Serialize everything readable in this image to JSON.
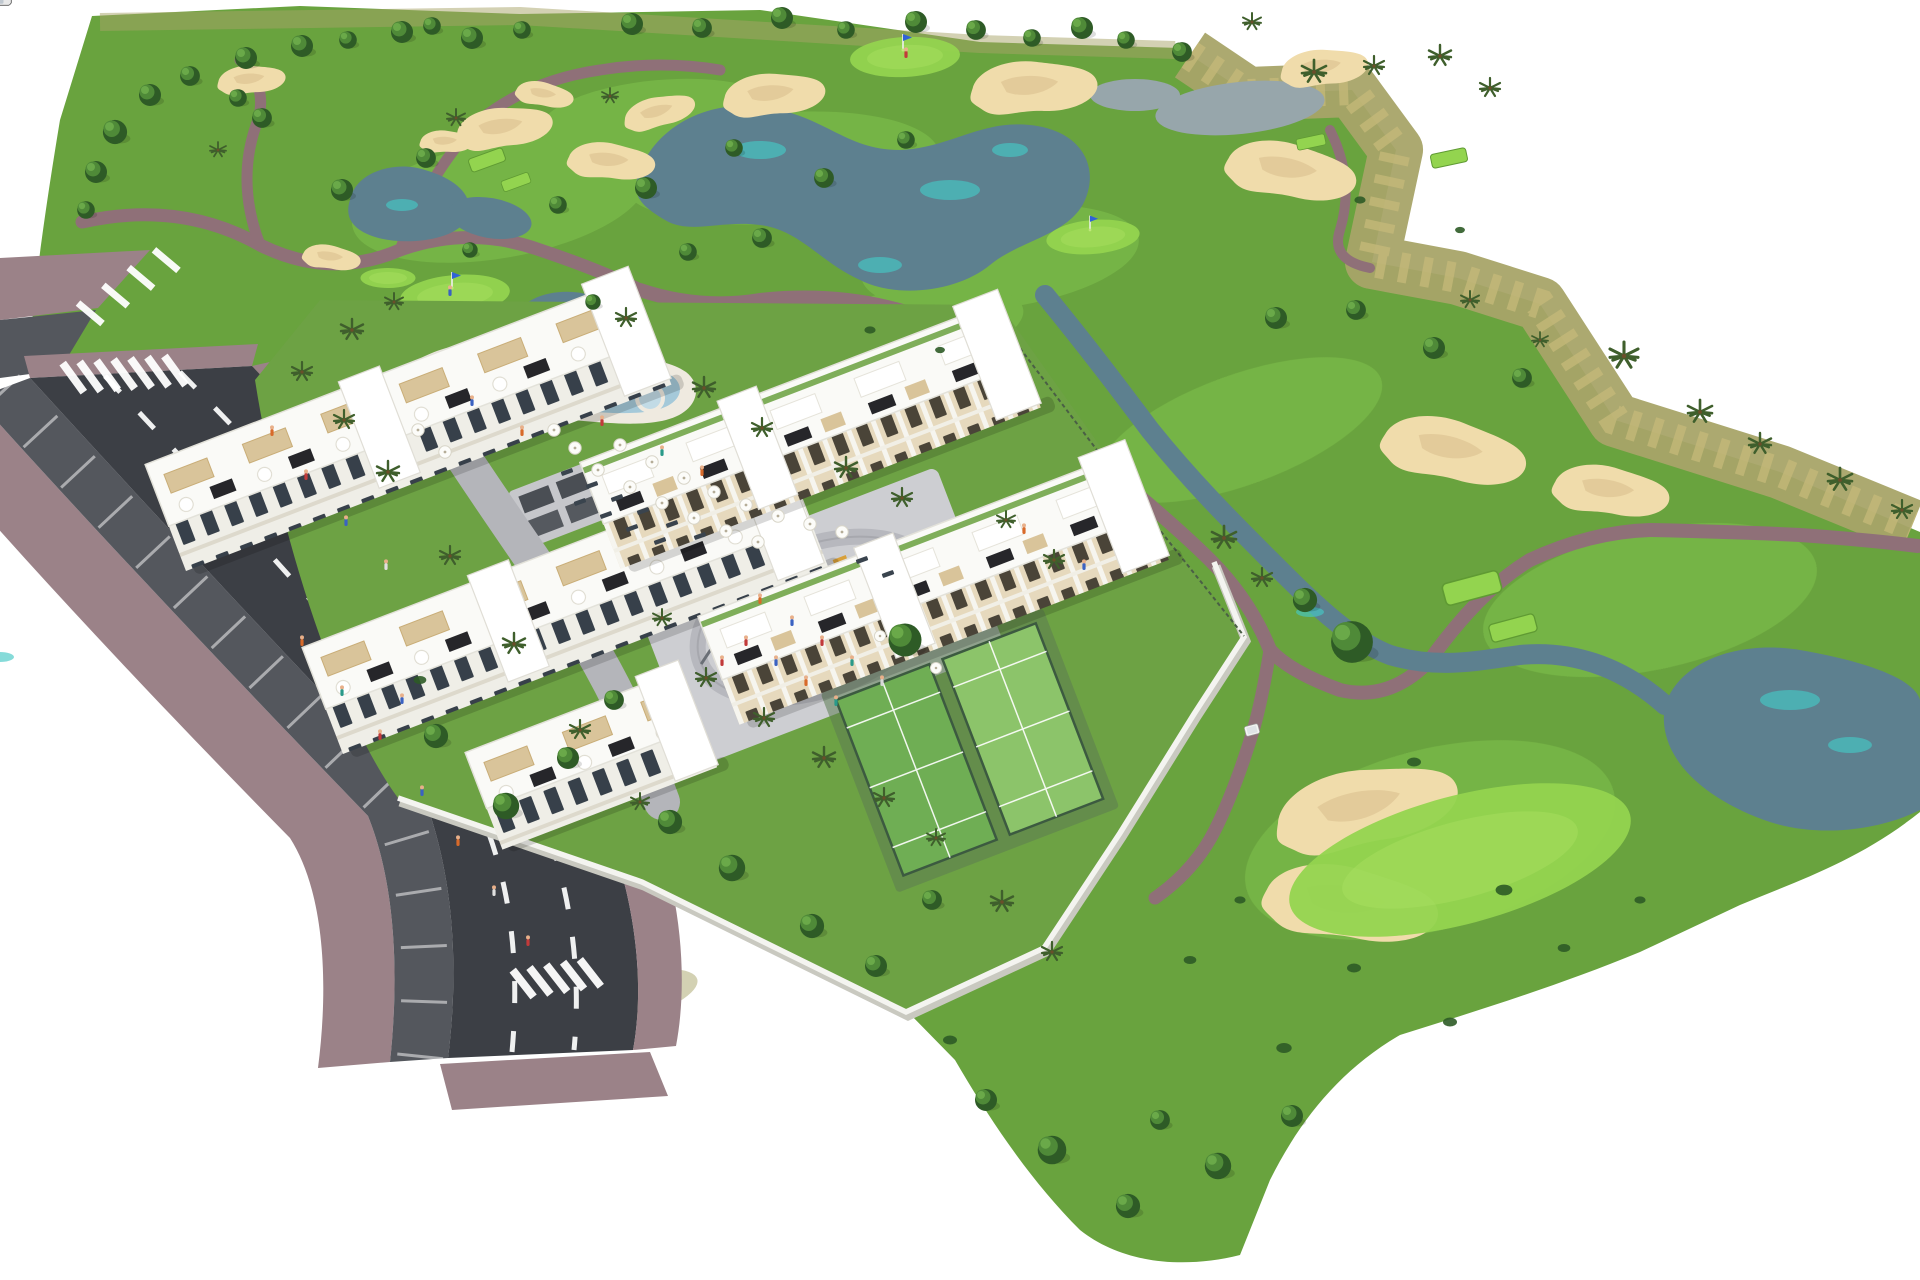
{
  "meta": {
    "title": "Aerial 3D masterplan render - golf resort apartments",
    "description": "Bird's-eye architectural rendering of white apartment blocks with roof terraces beside a golf course with lakes, sand bunkers, cart paths, a lagoon pool, playground plaza, padel courts and a tree-lined access road on white background.",
    "features": [
      "golf-course",
      "lakes",
      "streams",
      "sand-bunkers",
      "cart-paths",
      "apartment-blocks",
      "roof-terraces",
      "swimming-pool",
      "sun-umbrellas",
      "playground-plaza",
      "padel-courts",
      "access-road",
      "street-parking",
      "crosswalks",
      "perimeter-wall",
      "golf-greens-with-flags",
      "golf-cart",
      "palm-trees"
    ]
  },
  "palette": {
    "grass": "#69a33e",
    "fairway": "#82c44e",
    "teegreen": "#93d44f",
    "arid": "#a8a468",
    "aridlight": "#c8bb7a",
    "water": "#5d808f",
    "watercyan": "#45c8c4",
    "sand": "#f0dcab",
    "sandshade": "#d9bd8d",
    "path": "#8f7078",
    "road": "#3c3f45",
    "parking": "#54575d",
    "sidewalk": "#9b8288",
    "plaza": "#cdced2",
    "wall": "#f4f4f0",
    "building": "#fafaf7",
    "facade": "#efeee7",
    "window": "#37404a",
    "wood": "#c39a63",
    "woodlight": "#d9c49a",
    "panel": "#26262a",
    "poolwater": "#a5c9d9",
    "pooldeck": "#efeae0",
    "court": "#6fae54",
    "treedark": "#2e5b26",
    "tree": "#4f8a38",
    "treelight": "#6fae4c",
    "palm": "#3f5f2c",
    "shadow": "#00000026",
    "skin": "#e8b08a"
  },
  "scatter": {
    "trees": {
      "sym": "tree",
      "items": [
        [
          150,
          95,
          1
        ],
        [
          115,
          132,
          1.1
        ],
        [
          96,
          172,
          1
        ],
        [
          86,
          210,
          0.8
        ],
        [
          190,
          76,
          0.9
        ],
        [
          246,
          58,
          1
        ],
        [
          302,
          46,
          1
        ],
        [
          348,
          40,
          0.8
        ],
        [
          402,
          32,
          1
        ],
        [
          432,
          26,
          0.8
        ],
        [
          472,
          38,
          1
        ],
        [
          522,
          30,
          0.8
        ],
        [
          632,
          24,
          1
        ],
        [
          702,
          28,
          0.9
        ],
        [
          782,
          18,
          1
        ],
        [
          846,
          30,
          0.8
        ],
        [
          916,
          22,
          1
        ],
        [
          976,
          30,
          0.9
        ],
        [
          1032,
          38,
          0.8
        ],
        [
          1082,
          28,
          1
        ],
        [
          1126,
          40,
          0.8
        ],
        [
          1182,
          52,
          0.9
        ],
        [
          262,
          118,
          0.9
        ],
        [
          238,
          98,
          0.8
        ],
        [
          342,
          190,
          1
        ],
        [
          426,
          158,
          0.9
        ],
        [
          558,
          205,
          0.8
        ],
        [
          646,
          188,
          1
        ],
        [
          734,
          148,
          0.8
        ],
        [
          824,
          178,
          0.9
        ],
        [
          906,
          140,
          0.8
        ],
        [
          762,
          238,
          0.9
        ],
        [
          688,
          252,
          0.8
        ],
        [
          593,
          302,
          0.7
        ],
        [
          470,
          250,
          0.7
        ],
        [
          1276,
          318,
          1
        ],
        [
          1356,
          310,
          0.9
        ],
        [
          1434,
          348,
          1
        ],
        [
          1522,
          378,
          0.9
        ],
        [
          1352,
          642,
          1.9
        ],
        [
          1305,
          600,
          1.1
        ],
        [
          1052,
          1150,
          1.3
        ],
        [
          1128,
          1206,
          1.1
        ],
        [
          986,
          1100,
          1
        ],
        [
          1218,
          1166,
          1.2
        ],
        [
          1292,
          1116,
          1
        ],
        [
          1160,
          1120,
          0.9
        ],
        [
          436,
          736,
          1.1
        ],
        [
          506,
          806,
          1.2
        ],
        [
          568,
          758,
          1
        ],
        [
          614,
          700,
          0.9
        ],
        [
          670,
          822,
          1.1
        ],
        [
          732,
          868,
          1.2
        ],
        [
          812,
          926,
          1.1
        ],
        [
          876,
          966,
          1
        ],
        [
          932,
          900,
          0.9
        ],
        [
          905,
          640,
          1.5
        ]
      ]
    },
    "palms": {
      "sym": "palm",
      "items": [
        [
          302,
          372,
          1
        ],
        [
          344,
          420,
          1
        ],
        [
          388,
          472,
          1.1
        ],
        [
          450,
          556,
          1
        ],
        [
          514,
          644,
          1.1
        ],
        [
          580,
          730,
          1
        ],
        [
          640,
          802,
          0.9
        ],
        [
          352,
          330,
          1.1
        ],
        [
          394,
          302,
          0.9
        ],
        [
          626,
          318,
          1
        ],
        [
          704,
          388,
          1.1
        ],
        [
          762,
          428,
          1
        ],
        [
          846,
          468,
          1.1
        ],
        [
          902,
          498,
          1
        ],
        [
          662,
          618,
          0.9
        ],
        [
          706,
          678,
          1
        ],
        [
          764,
          718,
          1
        ],
        [
          824,
          758,
          1.1
        ],
        [
          884,
          798,
          1
        ],
        [
          936,
          838,
          0.9
        ],
        [
          1224,
          538,
          1.2
        ],
        [
          1262,
          578,
          1
        ],
        [
          1006,
          520,
          0.9
        ],
        [
          1054,
          560,
          1
        ],
        [
          1002,
          902,
          1.1
        ],
        [
          1052,
          952,
          1
        ],
        [
          456,
          118,
          0.9
        ],
        [
          610,
          96,
          0.8
        ],
        [
          218,
          150,
          0.8
        ],
        [
          1314,
          72,
          1.2
        ],
        [
          1374,
          66,
          1
        ],
        [
          1440,
          56,
          1.1
        ],
        [
          1490,
          88,
          1
        ],
        [
          1252,
          22,
          0.9
        ],
        [
          1624,
          356,
          1.4
        ],
        [
          1700,
          412,
          1.2
        ],
        [
          1760,
          444,
          1.1
        ],
        [
          1840,
          480,
          1.2
        ],
        [
          1902,
          510,
          1
        ],
        [
          1470,
          300,
          0.9
        ],
        [
          1540,
          340,
          0.8
        ]
      ]
    },
    "bushes": {
      "sym": "bush",
      "items": [
        [
          1414,
          762,
          1
        ],
        [
          1504,
          890,
          1.2
        ],
        [
          1354,
          968,
          1
        ],
        [
          1284,
          1048,
          1.1
        ],
        [
          1450,
          1022,
          1
        ],
        [
          1564,
          948,
          0.9
        ],
        [
          1640,
          900,
          0.8
        ],
        [
          420,
          680,
          0.9
        ],
        [
          950,
          1040,
          1
        ],
        [
          1240,
          900,
          0.8
        ],
        [
          1190,
          960,
          0.9
        ],
        [
          870,
          330,
          0.8
        ],
        [
          940,
          350,
          0.7
        ],
        [
          1360,
          200,
          0.8
        ],
        [
          1460,
          230,
          0.7
        ]
      ]
    },
    "bunkers": {
      "sym": "bunker",
      "items": [
        [
          505,
          128,
          1,
          -8
        ],
        [
          612,
          162,
          0.9,
          5
        ],
        [
          660,
          112,
          0.75,
          -15
        ],
        [
          447,
          142,
          0.55,
          0
        ],
        [
          252,
          80,
          0.7,
          -5
        ],
        [
          332,
          258,
          0.6,
          8
        ],
        [
          775,
          95,
          1.05,
          -5
        ],
        [
          1035,
          88,
          1.3,
          -3
        ],
        [
          1292,
          172,
          1.35,
          10
        ],
        [
          1325,
          68,
          0.9,
          -6
        ],
        [
          1455,
          452,
          1.5,
          12
        ],
        [
          1612,
          492,
          1.2,
          8
        ],
        [
          305,
          438,
          0.6,
          -10
        ],
        [
          1368,
          808,
          1.9,
          -12
        ],
        [
          1352,
          905,
          1.8,
          8
        ],
        [
          545,
          95,
          0.6,
          10
        ]
      ]
    },
    "tees": {
      "sym": "tee",
      "items": [
        [
          487,
          160,
          1,
          -20
        ],
        [
          516,
          182,
          0.8,
          -20
        ],
        [
          602,
          315,
          0.85,
          -20
        ],
        [
          641,
          337,
          0.7,
          -20
        ],
        [
          1472,
          588,
          1.6,
          -15
        ],
        [
          1513,
          628,
          1.3,
          -15
        ],
        [
          1449,
          158,
          1,
          -12
        ],
        [
          1311,
          142,
          0.8,
          -12
        ]
      ]
    },
    "greens": {
      "sym": "green",
      "items": [
        [
          455,
          295,
          1,
          -5
        ],
        [
          905,
          57,
          1,
          -3
        ],
        [
          1093,
          237,
          0.85,
          -5
        ],
        [
          388,
          278,
          0.5,
          0
        ],
        [
          1460,
          860,
          3.2,
          -15
        ]
      ]
    },
    "flags": {
      "sym": "flag",
      "items": [
        [
          452,
          288,
          1
        ],
        [
          903,
          50,
          1
        ],
        [
          1090,
          230,
          0.9
        ]
      ]
    },
    "umbrellas": {
      "sym": "umbrella",
      "items": [
        [
          620,
          445
        ],
        [
          652,
          462
        ],
        [
          684,
          478
        ],
        [
          714,
          492
        ],
        [
          746,
          505
        ],
        [
          778,
          516
        ],
        [
          810,
          524
        ],
        [
          842,
          532
        ],
        [
          598,
          470
        ],
        [
          630,
          487
        ],
        [
          662,
          503
        ],
        [
          694,
          518
        ],
        [
          726,
          531
        ],
        [
          758,
          542
        ],
        [
          575,
          448
        ],
        [
          554,
          430
        ],
        [
          880,
          636,
          0.9
        ],
        [
          936,
          668,
          0.9
        ],
        [
          418,
          430
        ],
        [
          445,
          452
        ]
      ]
    },
    "loungers": {
      "sym": "lounger",
      "items": [
        [
          567,
          472,
          1,
          -20
        ],
        [
          592,
          485,
          1,
          -20
        ],
        [
          617,
          498,
          1,
          -20
        ],
        [
          643,
          511,
          1,
          -20
        ],
        [
          672,
          524,
          1,
          -20
        ],
        [
          700,
          536,
          1,
          -20
        ],
        [
          580,
          502,
          1,
          -20
        ],
        [
          606,
          515,
          1,
          -20
        ],
        [
          632,
          528,
          1,
          -20
        ],
        [
          660,
          541,
          1,
          -20
        ],
        [
          862,
          560,
          1,
          -20
        ],
        [
          888,
          574,
          1,
          -20
        ]
      ]
    },
    "cars_parked": {
      "sym": "car",
      "items": [
        [
          30,
          336,
          50,
          "#c8c8cc"
        ],
        [
          62,
          318,
          50,
          "#e8e8e8"
        ],
        [
          50,
          430,
          52,
          "#e9e9ea"
        ],
        [
          80,
          487,
          52,
          "#223f8e"
        ],
        [
          106,
          529,
          52,
          "#dddddd"
        ],
        [
          129,
          566,
          52,
          "#a9a9af"
        ],
        [
          155,
          607,
          52,
          "#b22a2a"
        ],
        [
          182,
          648,
          53,
          "#2f79d8"
        ],
        [
          209,
          690,
          54,
          "#3f8f3f"
        ],
        [
          236,
          731,
          54,
          "#d8d8d8"
        ],
        [
          263,
          772,
          55,
          "#7a4526"
        ],
        [
          292,
          815,
          56,
          "#20306a"
        ],
        [
          320,
          858,
          56,
          "#8a8a90"
        ],
        [
          350,
          902,
          57,
          "#cfcfd4"
        ],
        [
          380,
          948,
          58,
          "#23408c"
        ]
      ]
    },
    "cars_road": {
      "sym": "car",
      "items": [
        [
          240,
          470,
          52,
          "#b8b8bc"
        ],
        [
          330,
          540,
          52,
          "#f2f2f2"
        ],
        [
          310,
          772,
          55,
          "#c03030"
        ],
        [
          364,
          800,
          55,
          "#2f79d8"
        ],
        [
          404,
          908,
          57,
          "#3f8f3f"
        ],
        [
          436,
          958,
          58,
          "#8a8a90"
        ],
        [
          472,
          1032,
          58,
          "#2d4fa0"
        ]
      ]
    },
    "cars_inner": {
      "sym": "car",
      "items": [
        [
          604,
          520,
          -21,
          "#2a56c8"
        ],
        [
          800,
          1042,
          -21,
          "#54555a"
        ],
        [
          1332,
          722,
          -21,
          "#2a56c8"
        ]
      ]
    },
    "carts": {
      "sym": "cart",
      "items": [
        [
          1252,
          730,
          1,
          -15
        ]
      ]
    },
    "people": {
      "sym": "person",
      "items": [
        [
          272,
          432,
          1,
          0,
          "#d86a2a"
        ],
        [
          306,
          476,
          1,
          0,
          "#c23a3a"
        ],
        [
          346,
          522,
          1,
          0,
          "#3a62c2"
        ],
        [
          386,
          566,
          1,
          0,
          "#e0e0e0"
        ],
        [
          302,
          642,
          1,
          0,
          "#d86a2a"
        ],
        [
          342,
          692,
          1,
          0,
          "#2a9a8a"
        ],
        [
          380,
          736,
          1,
          0,
          "#c23a3a"
        ],
        [
          422,
          792,
          1,
          0,
          "#3a62c2"
        ],
        [
          458,
          842,
          1,
          0,
          "#d86a2a"
        ],
        [
          494,
          892,
          1,
          0,
          "#e0e0e0"
        ],
        [
          528,
          942,
          1,
          0,
          "#c23a3a"
        ],
        [
          402,
          700,
          1,
          0,
          "#3a62c2"
        ],
        [
          760,
          600,
          1,
          0,
          "#d86a2a"
        ],
        [
          792,
          622,
          1,
          0,
          "#3a62c2"
        ],
        [
          822,
          642,
          1,
          0,
          "#c23a3a"
        ],
        [
          852,
          662,
          1,
          0,
          "#2a9a8a"
        ],
        [
          882,
          682,
          1,
          0,
          "#d8d8d8"
        ],
        [
          746,
          642,
          1,
          0,
          "#c23a3a"
        ],
        [
          776,
          662,
          1,
          0,
          "#3a62c2"
        ],
        [
          806,
          682,
          1,
          0,
          "#d86a2a"
        ],
        [
          836,
          702,
          1,
          0,
          "#2a9a8a"
        ],
        [
          722,
          662,
          1,
          0,
          "#c23a3a"
        ],
        [
          472,
          402,
          1,
          0,
          "#3a62c2"
        ],
        [
          522,
          432,
          1,
          0,
          "#d86a2a"
        ],
        [
          602,
          422,
          1,
          0,
          "#c23a3a"
        ],
        [
          662,
          452,
          1,
          0,
          "#2a9a8a"
        ],
        [
          702,
          472,
          1,
          0,
          "#d86a2a"
        ],
        [
          450,
          292,
          1,
          0,
          "#3a62c2"
        ],
        [
          906,
          54,
          1,
          0,
          "#c23a3a"
        ],
        [
          1024,
          530,
          1,
          0,
          "#d86a2a"
        ],
        [
          1084,
          566,
          1,
          0,
          "#3a62c2"
        ]
      ]
    }
  }
}
